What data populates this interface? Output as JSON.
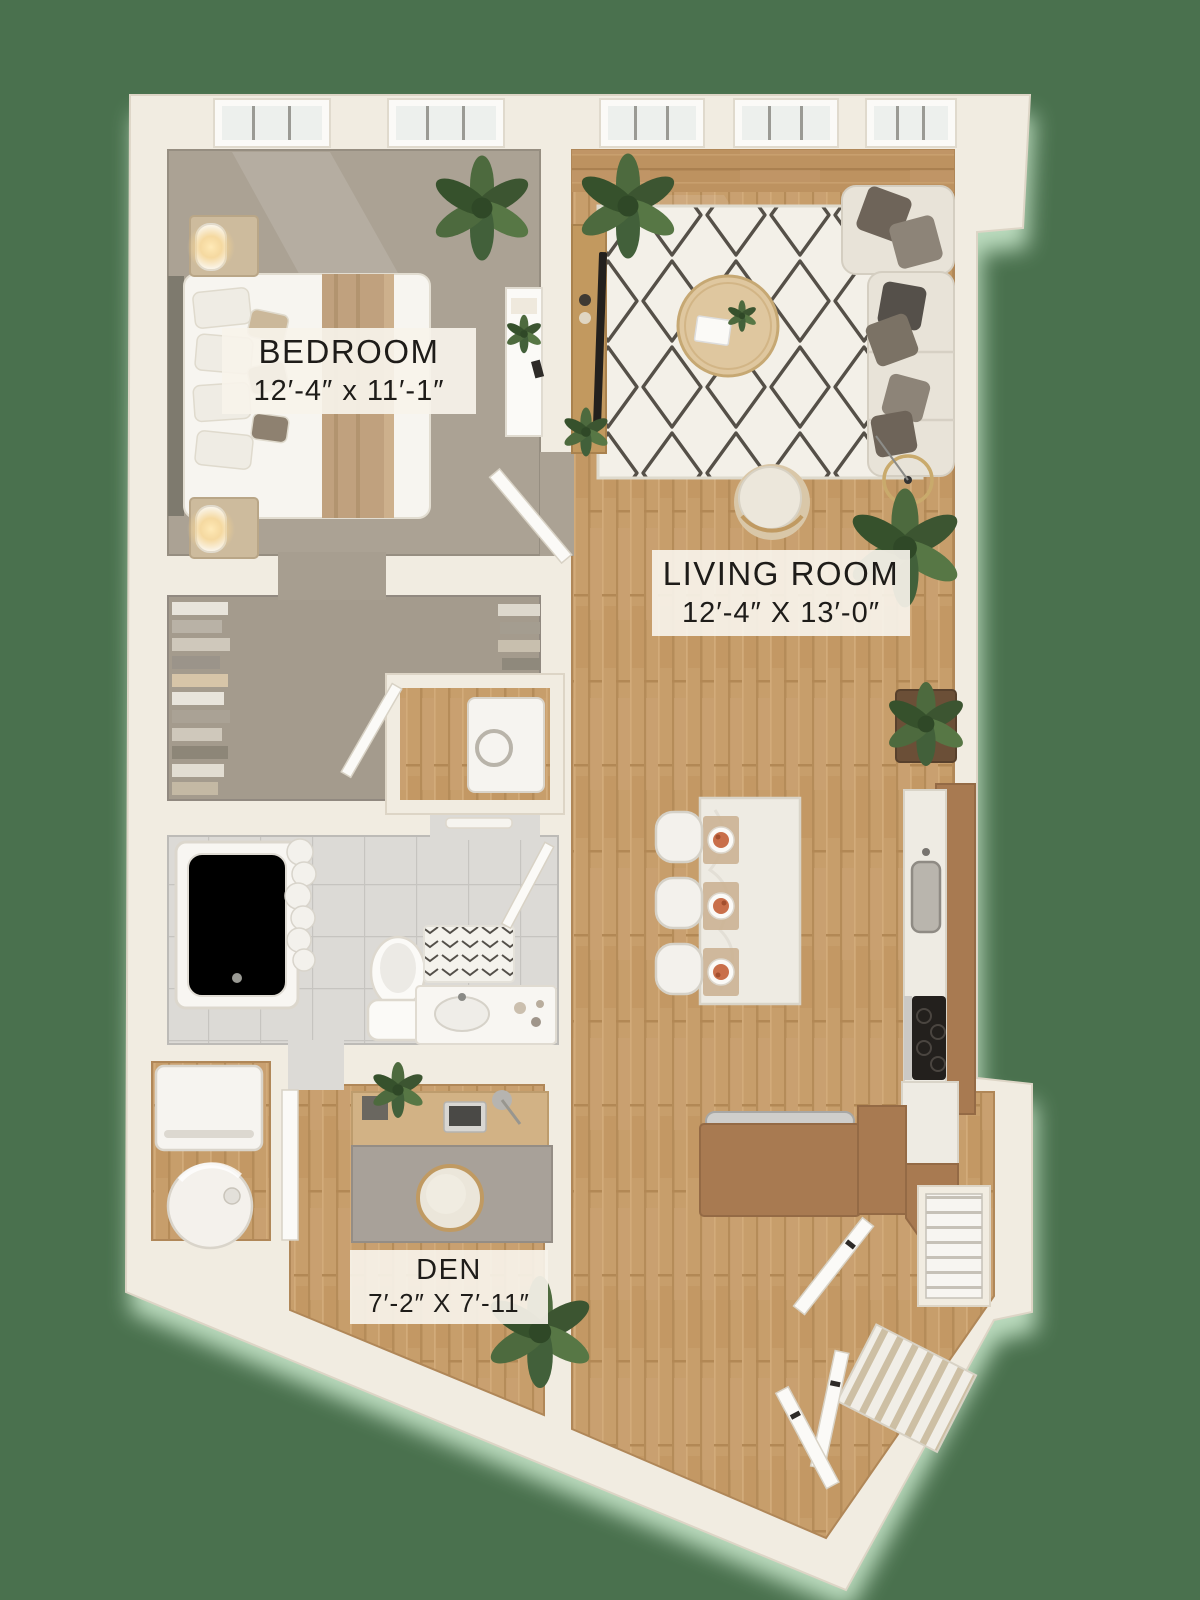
{
  "scene": {
    "kind": "apartment floor plan, 3D top-down rendering",
    "background_color": "#4a714e"
  },
  "labels": {
    "bedroom": {
      "name": "BEDROOM",
      "dimensions": "12′-4″ x 11′-1″"
    },
    "living_room": {
      "name": "LIVING ROOM",
      "dimensions": "12′-4″ X 13′-0″"
    },
    "den": {
      "name": "DEN",
      "dimensions": "7′-2″ X 7′-11″"
    }
  },
  "palette": {
    "background": "#4a714e",
    "walls": "#f1ece1",
    "wood_floor": "#c79e6b",
    "bedroom_carpet": "#aba294",
    "bathroom_tile": "#dbd9d5",
    "kitchen_cabinets": "#a87a51",
    "island_marble": "#eeebe3",
    "rug": "#f3f0e8",
    "rug_pattern": "#3a342c",
    "label_background": "rgba(247,243,234,0.92)",
    "label_text": "#1e1c19",
    "shadow_glow": "#cfeed2"
  }
}
